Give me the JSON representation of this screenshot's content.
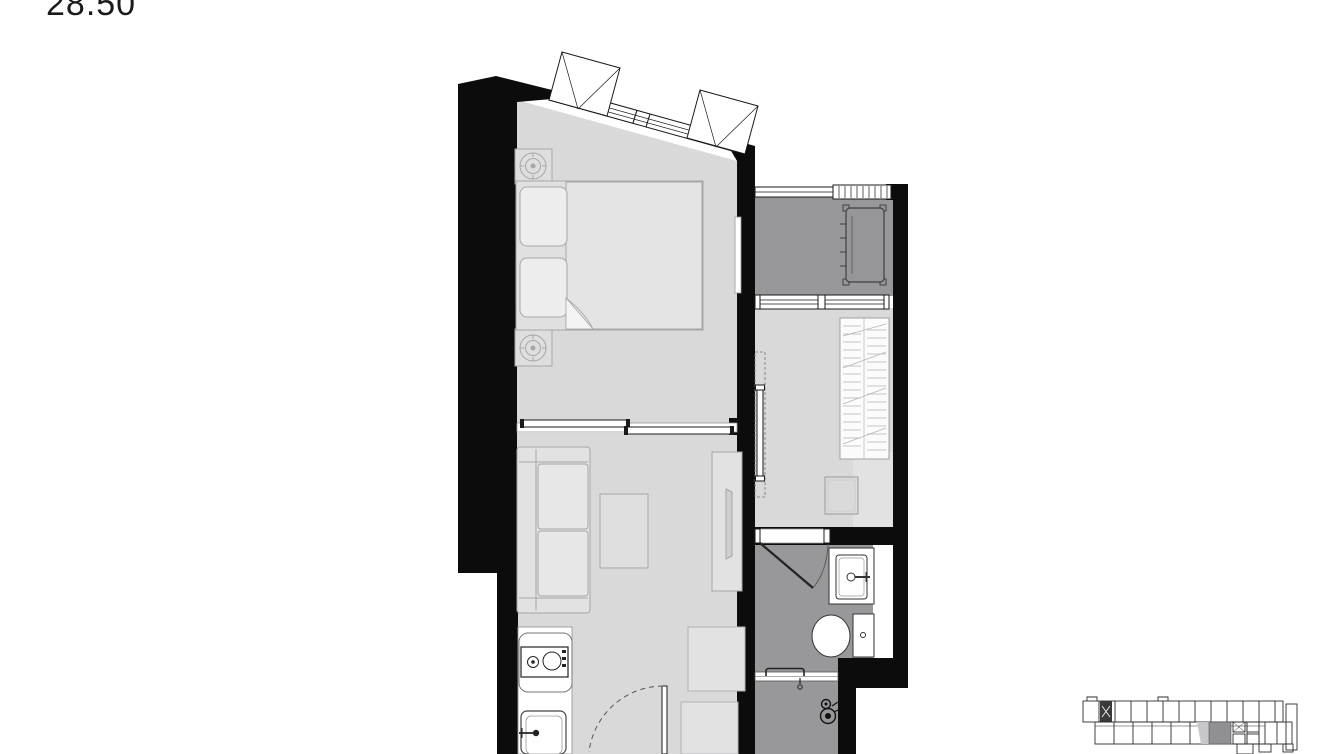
{
  "unit": {
    "area_label": "28.50"
  },
  "colors": {
    "wall": "#0c0c0c",
    "floor_light": "#d9d9da",
    "floor_dark": "#98989b",
    "floor_accent": "#e2e2e3",
    "furniture_fill": "#e2e2e3",
    "furniture_stroke": "#a6a6a8",
    "fixture_stroke": "#333333",
    "window_stroke": "#1a1a1a",
    "white": "#ffffff",
    "text": "#1a1a1a",
    "keyplan_line": "#2e2e2e",
    "keyplan_dark": "#3a3a3c",
    "keyplan_shade": "#c7c7c9",
    "keyplan_highlight": "#909092"
  },
  "floor_plan": {
    "rooms": [
      {
        "id": "bedroom",
        "floor": "light",
        "fixtures": [
          "double-bed",
          "pillow",
          "pillow",
          "nightstand-lamp",
          "nightstand-lamp",
          "wall-panel",
          "sliding-door",
          "awning-window",
          "awning-window"
        ]
      },
      {
        "id": "living-kitchen",
        "floor": "light",
        "fixtures": [
          "sofa",
          "coffee-table",
          "tv-console",
          "dining-table",
          "dining-table",
          "kitchen-counter",
          "cooktop",
          "kitchen-sink",
          "entrance-door"
        ]
      },
      {
        "id": "balcony",
        "floor": "dark",
        "fixtures": [
          "ac-condenser-unit",
          "railing",
          "louver-screen"
        ]
      },
      {
        "id": "dressing-area",
        "floor": "light",
        "fixtures": [
          "wardrobe",
          "stool",
          "pocket-sliding-door",
          "window"
        ]
      },
      {
        "id": "bathroom",
        "floor": "dark",
        "fixtures": [
          "washbasin",
          "toilet",
          "swing-door"
        ]
      },
      {
        "id": "shower",
        "floor": "dark",
        "fixtures": [
          "shower-set",
          "glass-partition"
        ]
      }
    ]
  },
  "key_plan": {
    "highlighted_unit": true
  }
}
